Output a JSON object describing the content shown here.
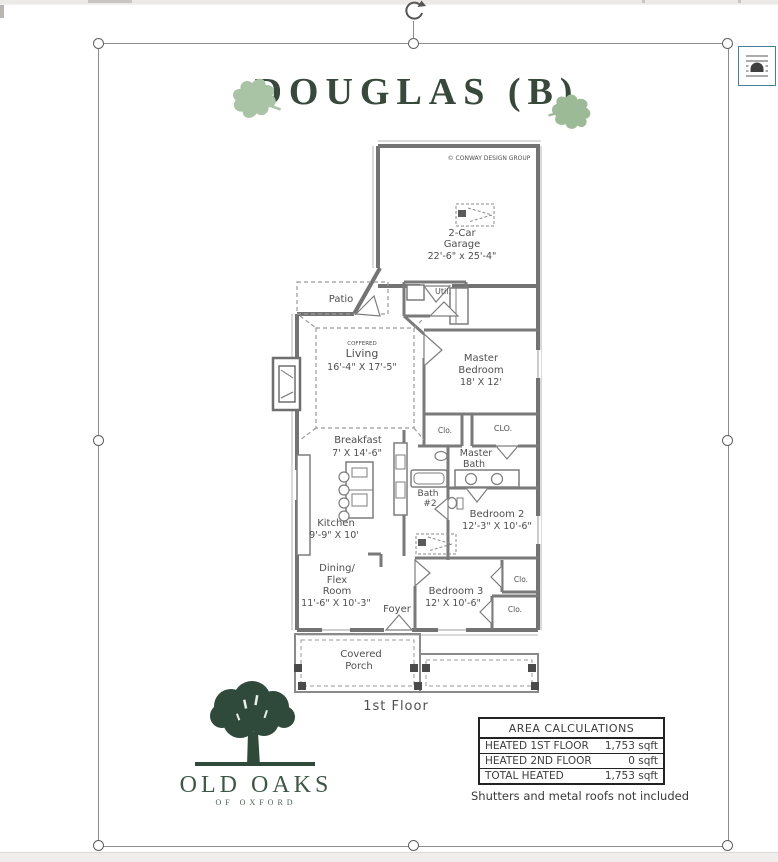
{
  "chrome": {
    "rotate_handle": "rotate-arrow",
    "layout_options_icon": "text-wrap-arch"
  },
  "colors": {
    "title_green": "#37493a",
    "leaf_green": "#a9c4a4",
    "logo_green": "#2f4a3b",
    "wall_gray": "#737373",
    "layout_btn_border": "#44809a"
  },
  "title": {
    "text": "DOUGLAS (B)"
  },
  "plan": {
    "copyright": "© CONWAY DESIGN GROUP",
    "garage": [
      "2-Car",
      "Garage",
      "22'-6\" x 25'-4\""
    ],
    "patio": "Patio",
    "util": "Util.",
    "living": [
      "COFFERED",
      "Living",
      "16'-4\" X 17'-5\""
    ],
    "master_bedroom": [
      "Master",
      "Bedroom",
      "18' X 12'"
    ],
    "breakfast": [
      "Breakfast",
      "7' X 14'-6\""
    ],
    "clo_hall": "Clo.",
    "clo_master": "CLO.",
    "master_bath": [
      "Master",
      "Bath"
    ],
    "bath2": [
      "Bath",
      "#2"
    ],
    "bedroom2": [
      "Bedroom 2",
      "12'-3\" X 10'-6\""
    ],
    "kitchen": [
      "Kitchen",
      "9'-9\" X 10'"
    ],
    "dining": [
      "Dining/",
      "Flex",
      "Room",
      "11'-6\" X 10'-3\""
    ],
    "foyer": "Foyer",
    "bedroom3": [
      "Bedroom 3",
      "12' X 10'-6\""
    ],
    "clo_bedroom2": "Clo.",
    "clo_bedroom3": "Clo.",
    "porch": [
      "Covered",
      "Porch"
    ],
    "floor_label": "1st Floor"
  },
  "logo": {
    "name": "OLD OAKS",
    "tagline": "OF OXFORD"
  },
  "area_table": {
    "title": "AREA CALCULATIONS",
    "rows": [
      {
        "label": "HEATED 1ST FLOOR",
        "value": "1,753 sqft"
      },
      {
        "label": "HEATED 2ND FLOOR",
        "value": "0 sqft"
      },
      {
        "label": "TOTAL HEATED",
        "value": "1,753 sqft"
      }
    ]
  },
  "note": "Shutters and metal roofs not included"
}
